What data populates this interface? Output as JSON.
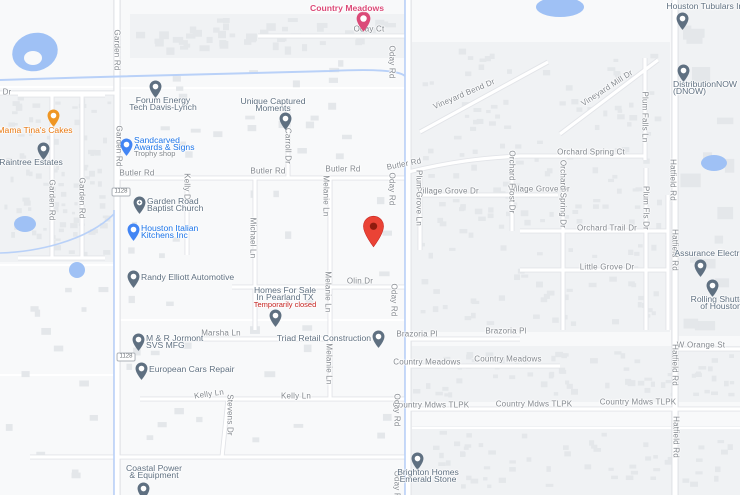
{
  "map": {
    "colors": {
      "bg": "#f8f9fa",
      "subdivision": "#f0f2f4",
      "building": "#e4e7ea",
      "water": "#9fc1f5",
      "creek": "#b9d1f8",
      "road_fill": "#ffffff",
      "road_casing": "#e2e4e8",
      "field_line": "#ffffff",
      "street_label": "#84898f",
      "poi_default": "#5f7081",
      "poi_blue": "#1a73e8",
      "poi_pin_blue": "#4285f4",
      "poi_orange": "#e8770e",
      "poi_orange_pin": "#ef9624",
      "poi_pink": "#db4a78",
      "closed_red": "#c5221f",
      "sub_gray": "#80868b",
      "marker_red": "#ea4335",
      "marker_dot": "#8f1b0e"
    },
    "route_shields": [
      {
        "label": "1128",
        "x": 121,
        "y": 192
      },
      {
        "label": "1128",
        "x": 126,
        "y": 357
      }
    ],
    "street_labels_h": [
      {
        "text": "Oday Ct",
        "x": 369,
        "y": 29,
        "rot": 0
      },
      {
        "text": "Butler Rd",
        "x": 137,
        "y": 173,
        "rot": 0
      },
      {
        "text": "Butler Rd",
        "x": 268,
        "y": 171,
        "rot": 0
      },
      {
        "text": "Butler Rd",
        "x": 343,
        "y": 169,
        "rot": 0
      },
      {
        "text": "Butler Rd",
        "x": 404,
        "y": 164,
        "rot": -11
      },
      {
        "text": "Village Grove Dr",
        "x": 448,
        "y": 191,
        "rot": 0
      },
      {
        "text": "Village Grove Dr",
        "x": 539,
        "y": 189,
        "rot": 0
      },
      {
        "text": "Orchard Spring Ct",
        "x": 591,
        "y": 152,
        "rot": 0
      },
      {
        "text": "Orchard Trail Dr",
        "x": 607,
        "y": 228,
        "rot": 0
      },
      {
        "text": "Little Grove Dr",
        "x": 607,
        "y": 267,
        "rot": 0
      },
      {
        "text": "Olin Dr",
        "x": 360,
        "y": 281,
        "rot": 0
      },
      {
        "text": "Marsha Ln",
        "x": 221,
        "y": 333,
        "rot": 0
      },
      {
        "text": "Brazoria Pl",
        "x": 417,
        "y": 334,
        "rot": 0
      },
      {
        "text": "Brazoria Pl",
        "x": 506,
        "y": 331,
        "rot": 0
      },
      {
        "text": "Country Meadows",
        "x": 427,
        "y": 362,
        "rot": 0
      },
      {
        "text": "Country Meadows",
        "x": 508,
        "y": 359,
        "rot": 0
      },
      {
        "text": "Country Mdws TLPK",
        "x": 431,
        "y": 405,
        "rot": 0
      },
      {
        "text": "Country Mdws TLPK",
        "x": 534,
        "y": 404,
        "rot": 0
      },
      {
        "text": "Country Mdws TLPK",
        "x": 638,
        "y": 402,
        "rot": 0
      },
      {
        "text": "Kelly Ln",
        "x": 209,
        "y": 394,
        "rot": -8
      },
      {
        "text": "Kelly Ln",
        "x": 296,
        "y": 396,
        "rot": 0
      },
      {
        "text": "W Orange St",
        "x": 701,
        "y": 345,
        "rot": 0
      },
      {
        "text": "Vineyard Bend Dr",
        "x": 464,
        "y": 94,
        "rot": -23
      },
      {
        "text": "Vineyard Mill Dr",
        "x": 607,
        "y": 88,
        "rot": -33
      },
      {
        "text": "Dr",
        "x": 7,
        "y": 92,
        "rot": 0
      }
    ],
    "street_labels_v": [
      {
        "text": "Garden Rd",
        "x": 117,
        "y": 50
      },
      {
        "text": "Garden Rd",
        "x": 119,
        "y": 146
      },
      {
        "text": "Garden Rd",
        "x": 52,
        "y": 200
      },
      {
        "text": "Garden Rd",
        "x": 82,
        "y": 198
      },
      {
        "text": "Carroll Dr",
        "x": 288,
        "y": 146
      },
      {
        "text": "Kelly Dr",
        "x": 187,
        "y": 188
      },
      {
        "text": "Michael Ln",
        "x": 253,
        "y": 238
      },
      {
        "text": "Melanie Ln",
        "x": 326,
        "y": 196
      },
      {
        "text": "Melanie Ln",
        "x": 328,
        "y": 292
      },
      {
        "text": "Melanie Ln",
        "x": 329,
        "y": 364
      },
      {
        "text": "Oday Rd",
        "x": 392,
        "y": 62
      },
      {
        "text": "Oday Rd",
        "x": 392,
        "y": 189
      },
      {
        "text": "Oday Rd",
        "x": 394,
        "y": 300
      },
      {
        "text": "Oday Rd",
        "x": 397,
        "y": 410
      },
      {
        "text": "Oday Rd",
        "x": 397,
        "y": 487
      },
      {
        "text": "Stevens Dr",
        "x": 230,
        "y": 415
      },
      {
        "text": "Plum Grove Ln",
        "x": 419,
        "y": 198
      },
      {
        "text": "Orchard Frost Dr",
        "x": 512,
        "y": 182
      },
      {
        "text": "Orchard Spring Dr",
        "x": 563,
        "y": 194
      },
      {
        "text": "Plum Falls Ln",
        "x": 645,
        "y": 117
      },
      {
        "text": "Plum Fls Dr",
        "x": 646,
        "y": 208
      },
      {
        "text": "Hatfield Rd",
        "x": 673,
        "y": 180
      },
      {
        "text": "Hatfield Rd",
        "x": 675,
        "y": 250
      },
      {
        "text": "Hatfield Rd",
        "x": 675,
        "y": 365
      },
      {
        "text": "Hatfield Rd",
        "x": 676,
        "y": 437
      }
    ],
    "pois": [
      {
        "id": "country-meadows",
        "lines": [
          "Country Meadows"
        ],
        "color": "#db4a78",
        "pin_color": "#db4a78",
        "bold": true,
        "label": {
          "x": 347,
          "y": 5,
          "align": "center"
        },
        "pin": {
          "x": 363,
          "y": 19,
          "size": 15
        }
      },
      {
        "id": "houston-tubulars",
        "lines": [
          "Houston Tubulars Inc"
        ],
        "label": {
          "x": 707,
          "y": 3,
          "align": "center"
        },
        "pin": {
          "x": 682,
          "y": 19,
          "size": 13
        }
      },
      {
        "id": "distributionnow",
        "lines": [
          "DistributionNOW",
          "(DNOW)"
        ],
        "label": {
          "x": 673,
          "y": 81,
          "align": "left"
        },
        "pin": {
          "x": 683,
          "y": 71,
          "size": 13
        }
      },
      {
        "id": "forum-energy",
        "lines": [
          "Forum Energy",
          "Tech Davis-Lynch"
        ],
        "label": {
          "x": 163,
          "y": 97,
          "align": "center"
        },
        "pin": {
          "x": 155,
          "y": 87,
          "size": 13
        }
      },
      {
        "id": "unique-captured-moments",
        "lines": [
          "Unique Captured",
          "Moments"
        ],
        "label": {
          "x": 273,
          "y": 98,
          "align": "center"
        },
        "pin": {
          "x": 285,
          "y": 119,
          "size": 13
        }
      },
      {
        "id": "mama-tinas-cakes",
        "lines": [
          "Mama Tina's Cakes"
        ],
        "color": "#e8770e",
        "pin_color": "#ef9624",
        "label": {
          "x": 35,
          "y": 127,
          "align": "center"
        },
        "pin": {
          "x": 53,
          "y": 116,
          "size": 13
        }
      },
      {
        "id": "sandcarved-awards",
        "lines": [
          "Sandcarved",
          "Awards & Signs"
        ],
        "color": "#1a73e8",
        "pin_color": "#4285f4",
        "sub": "Trophy shop",
        "sub_color": "#80868b",
        "sub_y": 150,
        "label": {
          "x": 134,
          "y": 137,
          "align": "left"
        },
        "pin": {
          "x": 126,
          "y": 145,
          "size": 13
        }
      },
      {
        "id": "raintree-estates",
        "lines": [
          "Raintree Estates"
        ],
        "label": {
          "x": 31,
          "y": 159,
          "align": "center"
        },
        "pin": {
          "x": 43,
          "y": 149,
          "size": 13
        }
      },
      {
        "id": "garden-road-baptist-church",
        "lines": [
          "Garden Road",
          "Baptist Church"
        ],
        "icon": "+",
        "label": {
          "x": 147,
          "y": 198,
          "align": "left"
        },
        "pin": {
          "x": 139,
          "y": 203,
          "size": 13
        }
      },
      {
        "id": "houston-italian-kitchens",
        "lines": [
          "Houston Italian",
          "Kitchens Inc"
        ],
        "color": "#1a73e8",
        "pin_color": "#4285f4",
        "label": {
          "x": 141,
          "y": 225,
          "align": "left"
        },
        "pin": {
          "x": 133,
          "y": 230,
          "size": 13
        }
      },
      {
        "id": "randy-elliott-automotive",
        "lines": [
          "Randy Elliott Automotive"
        ],
        "label": {
          "x": 141,
          "y": 274,
          "align": "left"
        },
        "pin": {
          "x": 133,
          "y": 277,
          "size": 13
        }
      },
      {
        "id": "homes-for-sale-pearland",
        "lines": [
          "Homes For Sale",
          "In Pearland TX"
        ],
        "sub": "Temporarily closed",
        "sub_color": "#c5221f",
        "sub_y": 301,
        "label": {
          "x": 285,
          "y": 287,
          "align": "center"
        },
        "pin": {
          "x": 275,
          "y": 316,
          "size": 13
        }
      },
      {
        "id": "m-r-jormont",
        "lines": [
          "M & R Jormont",
          "SVS MFG"
        ],
        "label": {
          "x": 146,
          "y": 335,
          "align": "left"
        },
        "pin": {
          "x": 138,
          "y": 340,
          "size": 13
        }
      },
      {
        "id": "european-cars-repair",
        "lines": [
          "European Cars Repair"
        ],
        "label": {
          "x": 149,
          "y": 366,
          "align": "left"
        },
        "pin": {
          "x": 141,
          "y": 369,
          "size": 13
        }
      },
      {
        "id": "triad-retail-construction",
        "lines": [
          "Triad Retail Construction"
        ],
        "label": {
          "x": 371,
          "y": 335,
          "align": "right"
        },
        "pin": {
          "x": 378,
          "y": 337,
          "size": 13
        }
      },
      {
        "id": "assurance-electric",
        "lines": [
          "Assurance Electric"
        ],
        "label": {
          "x": 710,
          "y": 250,
          "align": "center"
        },
        "pin": {
          "x": 700,
          "y": 266,
          "size": 13
        }
      },
      {
        "id": "rolling-shutters-houston",
        "lines": [
          "Rolling Shutters",
          "of Houston"
        ],
        "label": {
          "x": 721,
          "y": 296,
          "align": "center"
        },
        "pin": {
          "x": 712,
          "y": 286,
          "size": 13
        }
      },
      {
        "id": "brighton-homes-emerald-stone",
        "lines": [
          "Brighton Homes",
          "Emerald Stone"
        ],
        "label": {
          "x": 428,
          "y": 469,
          "align": "center"
        },
        "pin": {
          "x": 417,
          "y": 459,
          "size": 13
        }
      },
      {
        "id": "coastal-power-equipment",
        "lines": [
          "Coastal Power",
          "& Equipment"
        ],
        "label": {
          "x": 154,
          "y": 465,
          "align": "center"
        },
        "pin": {
          "x": 143,
          "y": 489,
          "size": 13
        }
      }
    ],
    "marker": {
      "x": 373,
      "y": 228,
      "tip_y": 250
    },
    "geometry": {
      "roads_major": [
        "M117 0 V495",
        "M408 0 V495",
        "M675 0 V495"
      ],
      "roads_minor": [
        "M258 36 H408",
        "M117 178 H408",
        "M408 172 C450 162 480 158 520 156 H645",
        "M232 287 H408",
        "M180 339 H330",
        "M140 399 H408",
        "M408 339 H520",
        "M408 366 H560",
        "M408 409 H740",
        "M675 349 H740",
        "M30 457 H408",
        "M420 195 H558",
        "M520 231 H668",
        "M520 270 H668",
        "M255 178 V330",
        "M330 178 V400",
        "M288 100 V178",
        "M187 178 V255",
        "M228 399 L222 457",
        "M420 178 V250",
        "M512 168 V231",
        "M563 168 V330",
        "M645 58 V160",
        "M646 168 V330",
        "M668 195 V330",
        "M420 132 L548 62",
        "M560 134 L658 60",
        "M52 95 V258",
        "M82 95 V258",
        "M18 95 H105",
        "M18 258 H105",
        "M0 93 H117"
      ],
      "field_lines": [
        "M0 87 H117",
        "M117 88 H408",
        "M0 375 H115",
        "M0 265 H115",
        "M408 428 H740",
        "M117 320 H408"
      ],
      "creeks": [
        "M0 80 C120 76 260 73 330 71 C370 69 398 70 405 76",
        "M405 0 V495",
        "M114 210 V495",
        "M114 214 C85 242 35 252 0 253"
      ],
      "ponds": [
        {
          "cx": 35,
          "cy": 52,
          "rx": 23,
          "ry": 19,
          "rot": -15
        },
        {
          "cx": 560,
          "cy": 7,
          "rx": 24,
          "ry": 10,
          "rot": 0
        },
        {
          "cx": 714,
          "cy": 163,
          "rx": 13,
          "ry": 8,
          "rot": 0
        },
        {
          "cx": 25,
          "cy": 224,
          "rx": 11,
          "ry": 8,
          "rot": 0
        },
        {
          "cx": 77,
          "cy": 270,
          "rx": 8,
          "ry": 8,
          "rot": 0
        }
      ],
      "lake_hole": {
        "cx": 33,
        "cy": 58,
        "rx": 9,
        "ry": 7
      },
      "zone_fills": [
        {
          "x": 130,
          "y": 14,
          "w": 278,
          "h": 44
        },
        {
          "x": 0,
          "y": 90,
          "w": 115,
          "h": 172
        },
        {
          "x": 412,
          "y": 42,
          "w": 258,
          "h": 290
        },
        {
          "x": 408,
          "y": 346,
          "w": 332,
          "h": 56
        },
        {
          "x": 412,
          "y": 426,
          "w": 328,
          "h": 69
        },
        {
          "x": 676,
          "y": 0,
          "w": 64,
          "h": 336
        }
      ]
    }
  }
}
